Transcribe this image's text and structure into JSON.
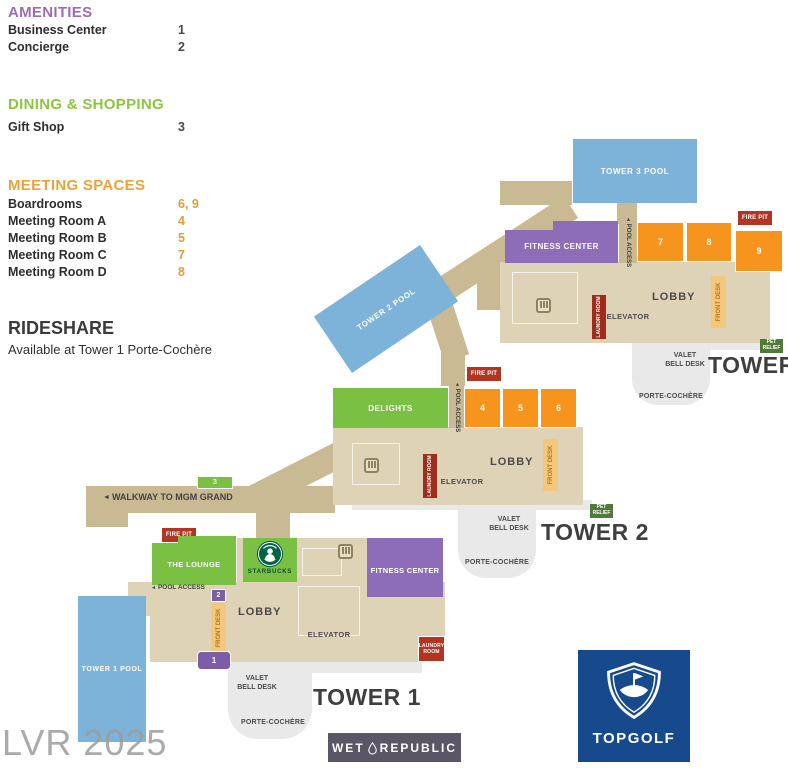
{
  "legend": {
    "sections": [
      {
        "title": "AMENITIES",
        "items": [
          {
            "label": "Business Center",
            "num": "1"
          },
          {
            "label": "Concierge",
            "num": "2"
          }
        ]
      },
      {
        "title": "DINING & SHOPPING",
        "items": [
          {
            "label": "Gift Shop",
            "num": "3"
          }
        ]
      },
      {
        "title": "MEETING SPACES",
        "items": [
          {
            "label": "Boardrooms",
            "num": "6, 9"
          },
          {
            "label": "Meeting Room A",
            "num": "4"
          },
          {
            "label": "Meeting Room B",
            "num": "5"
          },
          {
            "label": "Meeting Room C",
            "num": "7"
          },
          {
            "label": "Meeting Room D",
            "num": "8"
          }
        ]
      }
    ],
    "rideshare": {
      "title": "RIDESHARE",
      "subtitle": "Available at Tower 1 Porte-Cochère"
    }
  },
  "labels": {
    "lobby": "LOBBY",
    "elevator": "ELEVATOR",
    "laundry_room": "LAUNDRY ROOM",
    "laundry_1": "LAUNDRY",
    "laundry_2": "ROOM",
    "front_desk": "FRONT DESK",
    "fire_pit": "FIRE PIT",
    "pet_1": "PET",
    "pet_2": "RELIEF",
    "valet_1": "VALET",
    "valet_2": "BELL DESK",
    "porte_cochere": "PORTE-COCHÈRE",
    "pool_access": "POOL ACCESS",
    "walkway": "WALKWAY TO MGM GRAND",
    "fitness_center": "FITNESS CENTER",
    "delights": "DELIGHTS",
    "the_lounge": "THE LOUNGE",
    "starbucks": "STARBUCKS"
  },
  "towers": {
    "tower1": {
      "name": "TOWER 1",
      "pool": "TOWER 1 POOL",
      "business_center_marker": "1",
      "concierge_marker": "2"
    },
    "tower2": {
      "name": "TOWER 2",
      "pool": "TOWER 2 POOL",
      "rooms": [
        "4",
        "5",
        "6"
      ]
    },
    "tower3": {
      "name": "TOWER 3",
      "pool": "TOWER 3 POOL",
      "rooms": [
        "7",
        "8",
        "9"
      ]
    }
  },
  "markers": {
    "gift_shop": "3"
  },
  "logos": {
    "topgolf": "TOPGOLF",
    "wet": "WET",
    "republic": "REPUBLIC"
  },
  "watermark": "LVR 2025",
  "icons": {
    "left_arrow": "◄"
  },
  "colors": {
    "amenities_purple": "#9d6cb4",
    "dining_green": "#8cc640",
    "meeting_orange": "#eda33c",
    "pool_blue": "#7db3d8",
    "building_tan": "#ded3b6",
    "walkway_tan": "#c9ba93",
    "meeting_room_orange": "#f7941e",
    "fire_pit_red": "#b23422",
    "pet_relief_green": "#50793b",
    "topgolf_blue": "#174a8c",
    "wet_republic_slate": "#5a5665"
  }
}
